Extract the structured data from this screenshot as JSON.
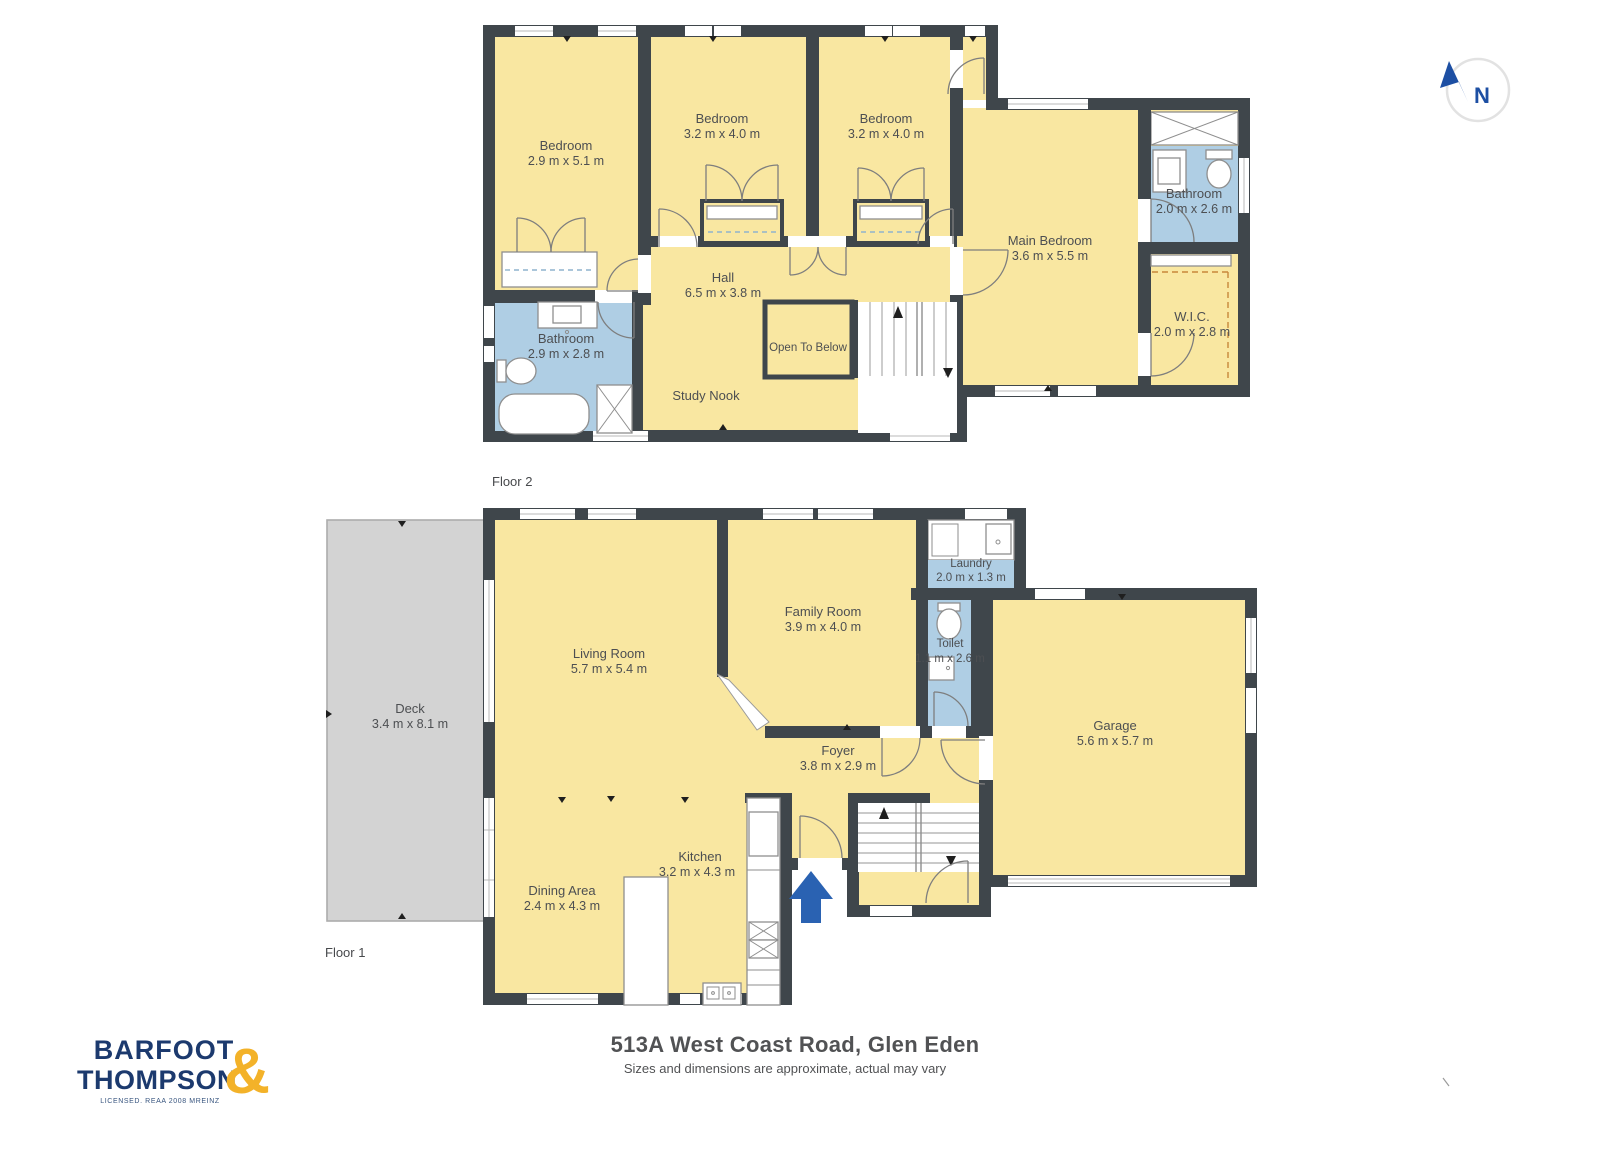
{
  "page": {
    "title": "513A West Coast Road, Glen Eden",
    "subtitle": "Sizes and dimensions are approximate, actual may vary"
  },
  "branding": {
    "line1": "BARFOOT",
    "line2": "THOMPSON",
    "ampersand": "&",
    "tagline": "LICENSED. REAA 2008 MREINZ"
  },
  "compass": {
    "label": "N"
  },
  "floor2": {
    "label": "Floor 2",
    "rooms": {
      "bedroom_left": {
        "name": "Bedroom",
        "dims": "2.9 m x 5.1 m"
      },
      "bedroom_mid": {
        "name": "Bedroom",
        "dims": "3.2 m x 4.0 m"
      },
      "bedroom_right": {
        "name": "Bedroom",
        "dims": "3.2 m x 4.0 m"
      },
      "main_bedroom": {
        "name": "Main Bedroom",
        "dims": "3.6 m x 5.5 m"
      },
      "ensuite_bathroom": {
        "name": "Bathroom",
        "dims": "2.0 m x 2.6 m"
      },
      "wic": {
        "name": "W.I.C.",
        "dims": "2.0 m x 2.8 m"
      },
      "hall": {
        "name": "Hall",
        "dims": "6.5 m x 3.8 m"
      },
      "bathroom": {
        "name": "Bathroom",
        "dims": "2.9 m x 2.8 m"
      },
      "open_to_below": {
        "name": "Open To Below"
      },
      "study_nook": {
        "name": "Study Nook"
      }
    }
  },
  "floor1": {
    "label": "Floor 1",
    "rooms": {
      "deck": {
        "name": "Deck",
        "dims": "3.4 m x 8.1 m"
      },
      "living_room": {
        "name": "Living Room",
        "dims": "5.7 m x 5.4 m"
      },
      "family_room": {
        "name": "Family Room",
        "dims": "3.9 m x 4.0 m"
      },
      "laundry": {
        "name": "Laundry",
        "dims": "2.0 m x 1.3 m"
      },
      "toilet": {
        "name": "Toilet",
        "dims": "1.1 m x 2.6 m"
      },
      "garage": {
        "name": "Garage",
        "dims": "5.6 m x 5.7 m"
      },
      "foyer": {
        "name": "Foyer",
        "dims": "3.8 m x 2.9 m"
      },
      "kitchen": {
        "name": "Kitchen",
        "dims": "3.2 m x 4.3 m"
      },
      "dining_area": {
        "name": "Dining Area",
        "dims": "2.4 m x 4.3 m"
      }
    }
  },
  "colors": {
    "wall": "#3F464B",
    "room_fill": "#F9E7A1",
    "wet_room_fill": "#AFCEE4",
    "deck_fill": "#D3D3D3",
    "entry_arrow": "#2A62B2",
    "logo_navy": "#1C3A6E",
    "logo_gold": "#F3B229",
    "label_text": "#4D4F52"
  }
}
